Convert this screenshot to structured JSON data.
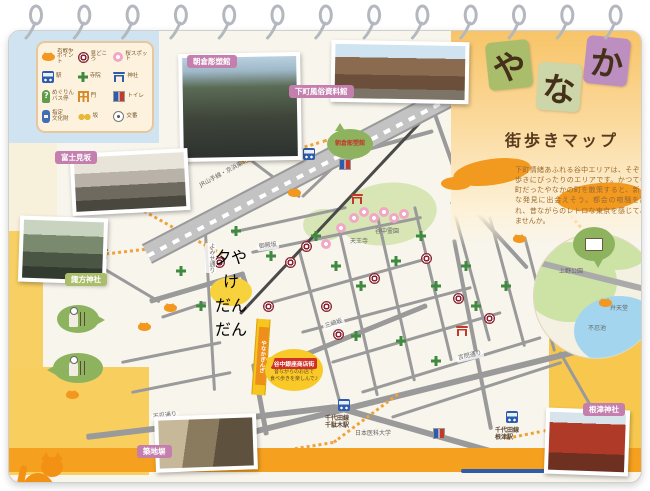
{
  "title": {
    "chars": [
      "や",
      "な",
      "か"
    ],
    "subtitle": "街歩きマップ",
    "description": "下町情緒あふれる谷中エリアは、そぞろ歩きにぴったりのエリアです。かつて寺町だったやなかの町を散策すると、新たな発見に出会えそう。都会の喧騒を離れ、昔ながらのレトロな東京を感じてみませんか。"
  },
  "legend": {
    "items": [
      {
        "icon": "cat-icon",
        "label": "お散歩\nポイント"
      },
      {
        "icon": "sight-icon",
        "label": "見どころ"
      },
      {
        "icon": "sakura-icon",
        "label": "桜スポット"
      },
      {
        "icon": "station-icon",
        "label": "駅"
      },
      {
        "icon": "temple-icon",
        "label": "寺院"
      },
      {
        "icon": "shrine-icon",
        "label": "神社"
      },
      {
        "icon": "bus-icon",
        "label": "めぐりん\nバス停"
      },
      {
        "icon": "gate-icon",
        "label": "門"
      },
      {
        "icon": "toilet-icon",
        "label": "トイレ"
      },
      {
        "icon": "culture-icon",
        "label": "指定\n文化財"
      },
      {
        "icon": "slope-icon",
        "label": "坂"
      },
      {
        "icon": "koban-icon",
        "label": "交番"
      }
    ]
  },
  "photos": [
    {
      "id": "asakura",
      "label": "朝倉彫塑館"
    },
    {
      "id": "shitamachi",
      "label": "下町風俗資料館"
    },
    {
      "id": "fujimizaka",
      "label": "富士見坂"
    },
    {
      "id": "suwa",
      "label": "諏方神社"
    },
    {
      "id": "tsukijibei",
      "label": "築地塀"
    },
    {
      "id": "nezu",
      "label": "根津神社"
    }
  ],
  "map": {
    "yuyake": "夕やけ\nだんだん",
    "asakura_bubble": "朝倉彫塑館",
    "ginza_street": "やなかぎんざ",
    "callout": {
      "title": "谷中銀座商店街",
      "line1": "昔ながらのお店で",
      "line2": "食べ歩きを楽しんで♪"
    },
    "stations": [
      {
        "label": "JR日暮里駅",
        "x": 294,
        "y": 117,
        "lx": 258,
        "ly": 105
      },
      {
        "label": "千代田線\n千駄木駅",
        "x": 329,
        "y": 368,
        "lx": 316,
        "ly": 384
      },
      {
        "label": "千代田線\n根津駅",
        "x": 497,
        "y": 380,
        "lx": 486,
        "ly": 396
      }
    ],
    "labels": [
      {
        "text": "JR山手線・京浜東北線",
        "x": 186,
        "y": 138,
        "rot": -28,
        "cls": "nobg"
      },
      {
        "text": "御殿坂",
        "x": 248,
        "y": 212,
        "rot": -8
      },
      {
        "text": "よみせ通り",
        "x": 196,
        "y": 212,
        "rot": 0,
        "cls": "vert"
      },
      {
        "text": "三崎坂",
        "x": 314,
        "y": 290,
        "rot": -18
      },
      {
        "text": "言問通り",
        "x": 447,
        "y": 322,
        "rot": -13
      },
      {
        "text": "不忍通り",
        "x": 142,
        "y": 382,
        "rot": -7
      },
      {
        "text": "谷中霊園",
        "x": 364,
        "y": 198,
        "rot": 0,
        "cls": "nobg"
      },
      {
        "text": "天王寺",
        "x": 339,
        "y": 208,
        "rot": 0,
        "cls": "nobg"
      },
      {
        "text": "上野公園",
        "x": 548,
        "y": 238,
        "rot": 0,
        "cls": "nobg"
      },
      {
        "text": "不忍池",
        "x": 577,
        "y": 295,
        "rot": 0,
        "cls": "nobg"
      },
      {
        "text": "弁天堂",
        "x": 599,
        "y": 275,
        "rot": 0,
        "cls": "nobg"
      },
      {
        "text": "日本医科大学",
        "x": 344,
        "y": 400,
        "rot": 0,
        "cls": "nobg"
      }
    ]
  }
}
